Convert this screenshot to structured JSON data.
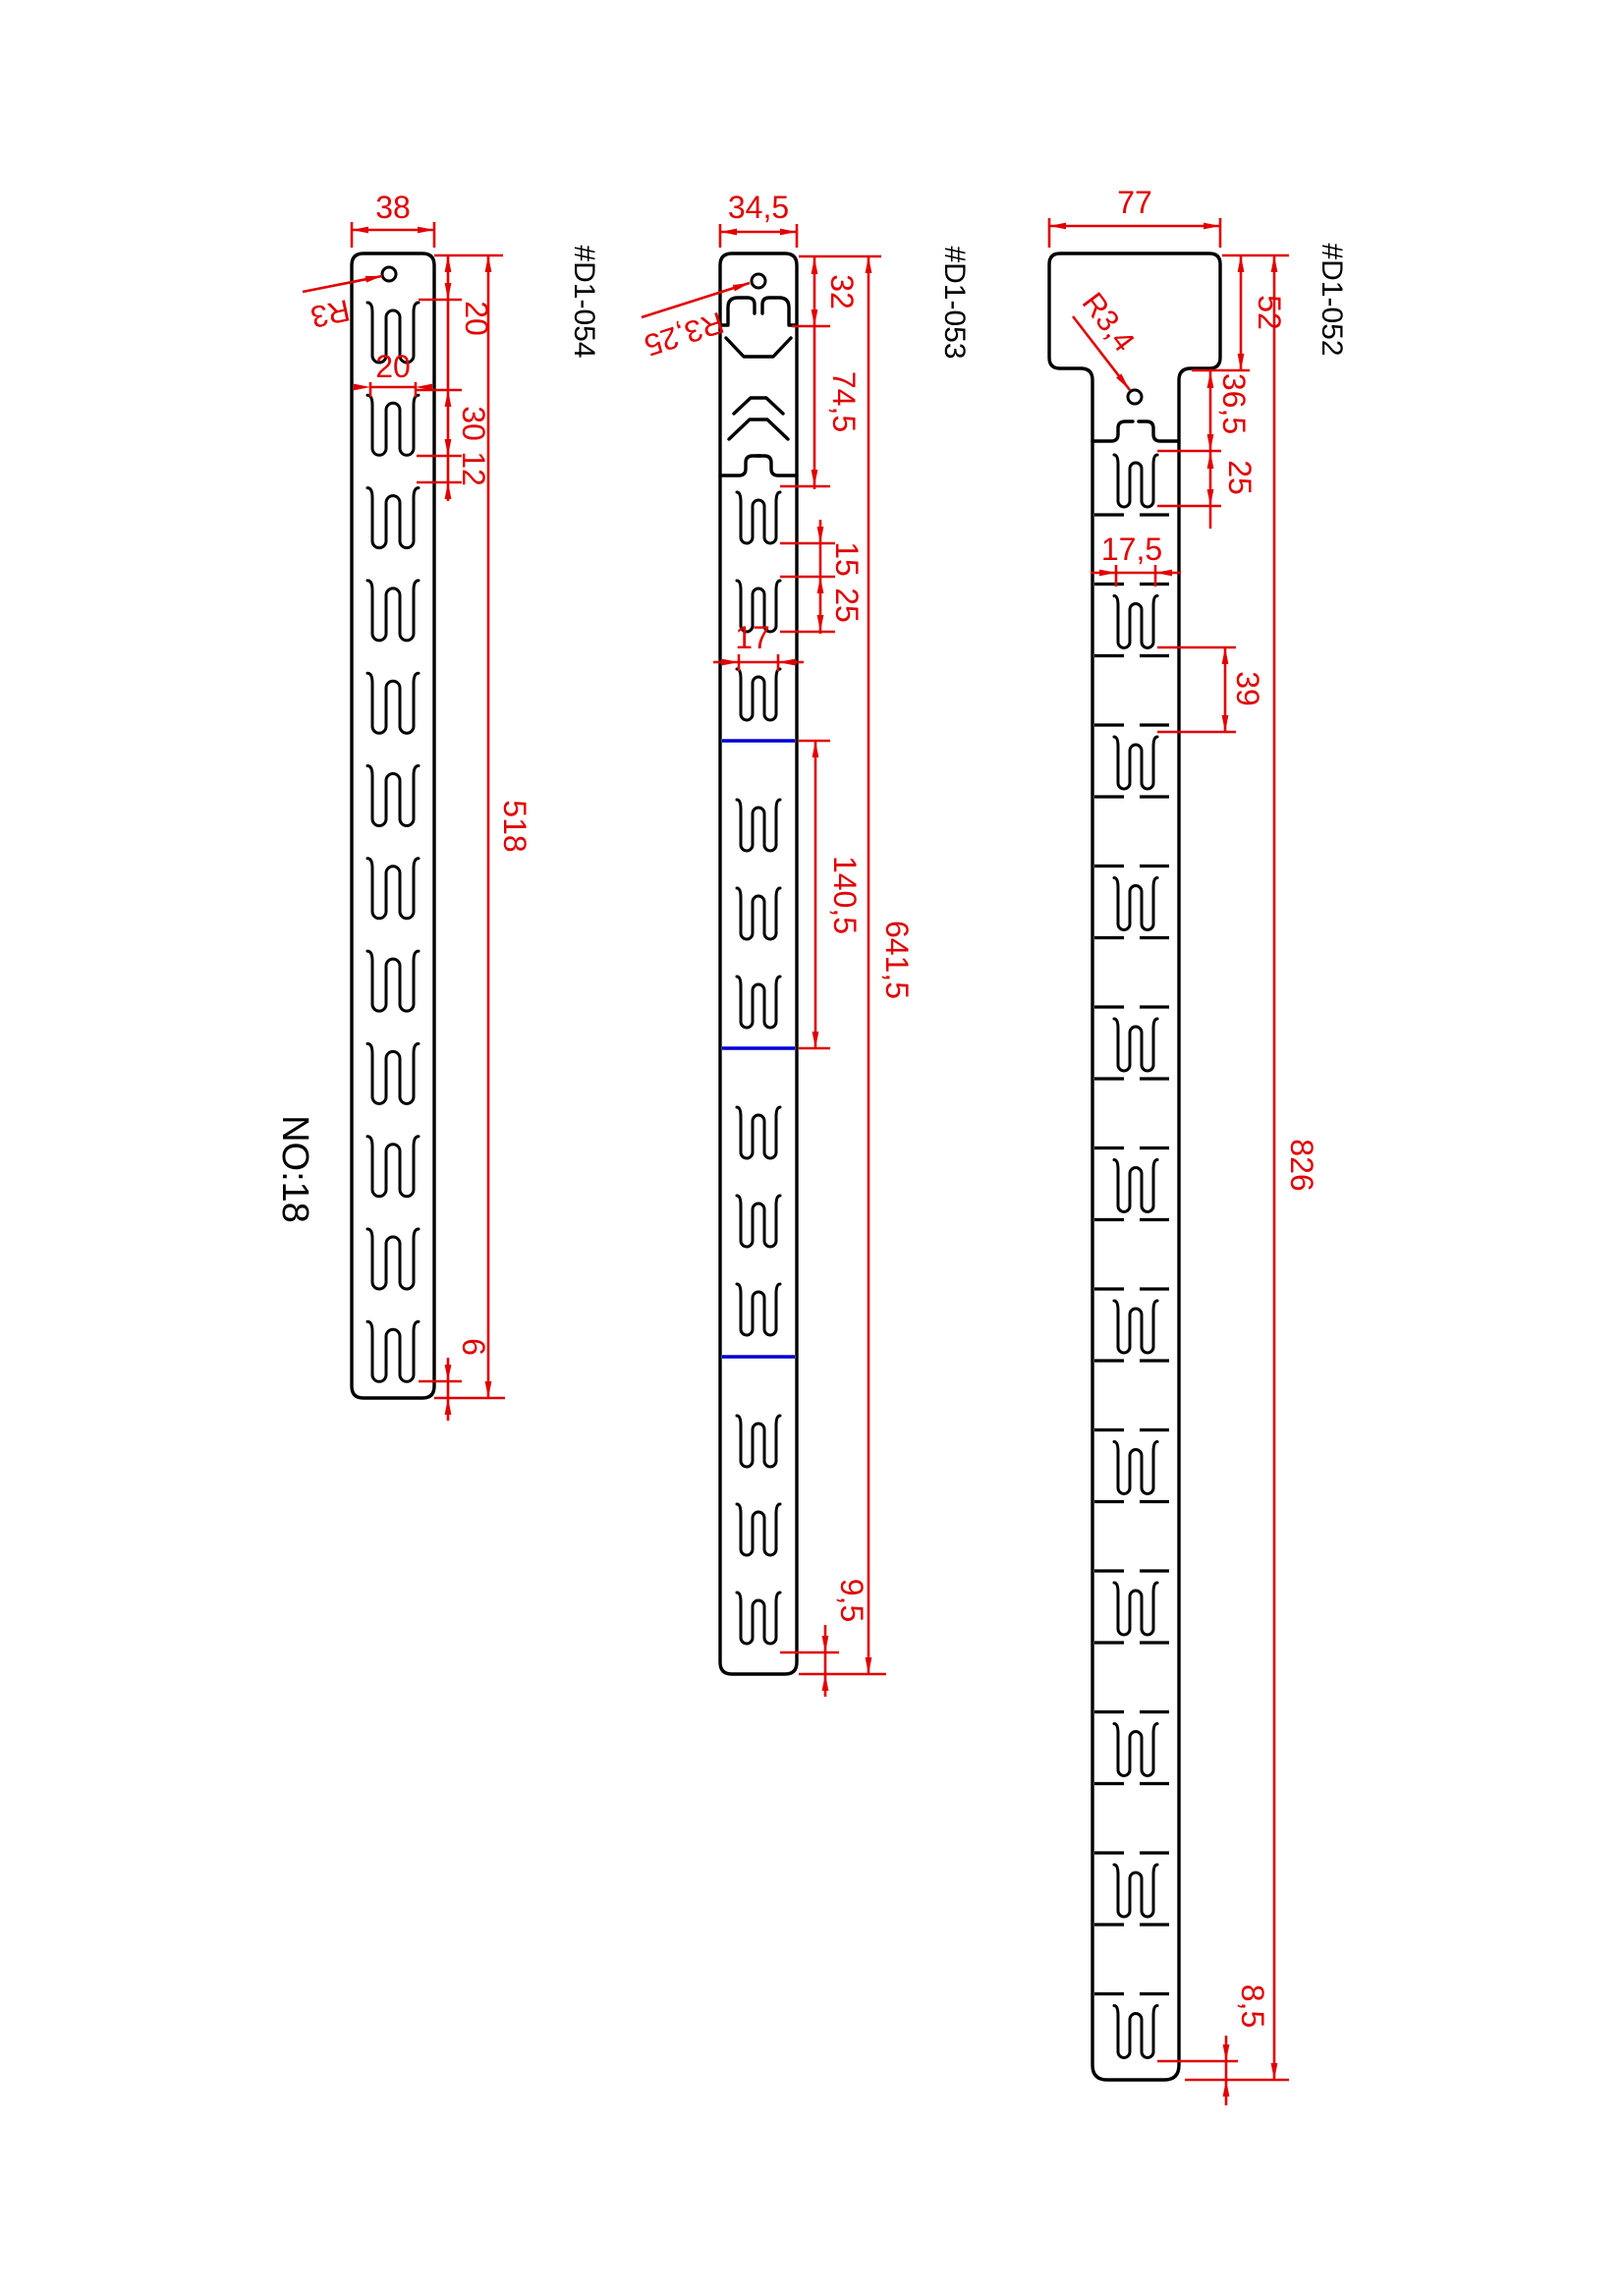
{
  "sheet": {
    "note": "NO:18",
    "colors": {
      "outline": "#000000",
      "dimension": "#e10000",
      "section_line": "#0000d8",
      "background": "#ffffff"
    }
  },
  "parts": [
    {
      "id": "#D1-054",
      "dims": {
        "width": "38",
        "hole": "R3",
        "top": "20",
        "slot_w": "20",
        "slot_h": "30",
        "gap": "12",
        "length": "518",
        "bottom": "6"
      }
    },
    {
      "id": "#D1-053",
      "dims": {
        "width": "34,5",
        "hole": "R3,25",
        "top": "32",
        "head": "74,5",
        "gap": "15",
        "slot_h": "25",
        "slot_w": "17",
        "section": "140,5",
        "length": "641,5",
        "bottom": "9,5"
      }
    },
    {
      "id": "#D1-052",
      "dims": {
        "width": "77",
        "hole": "R3,4",
        "head": "52",
        "top": "36,5",
        "slot_h": "25",
        "slot_w": "17,5",
        "spacing": "39",
        "length": "826",
        "bottom": "8,5"
      }
    }
  ]
}
